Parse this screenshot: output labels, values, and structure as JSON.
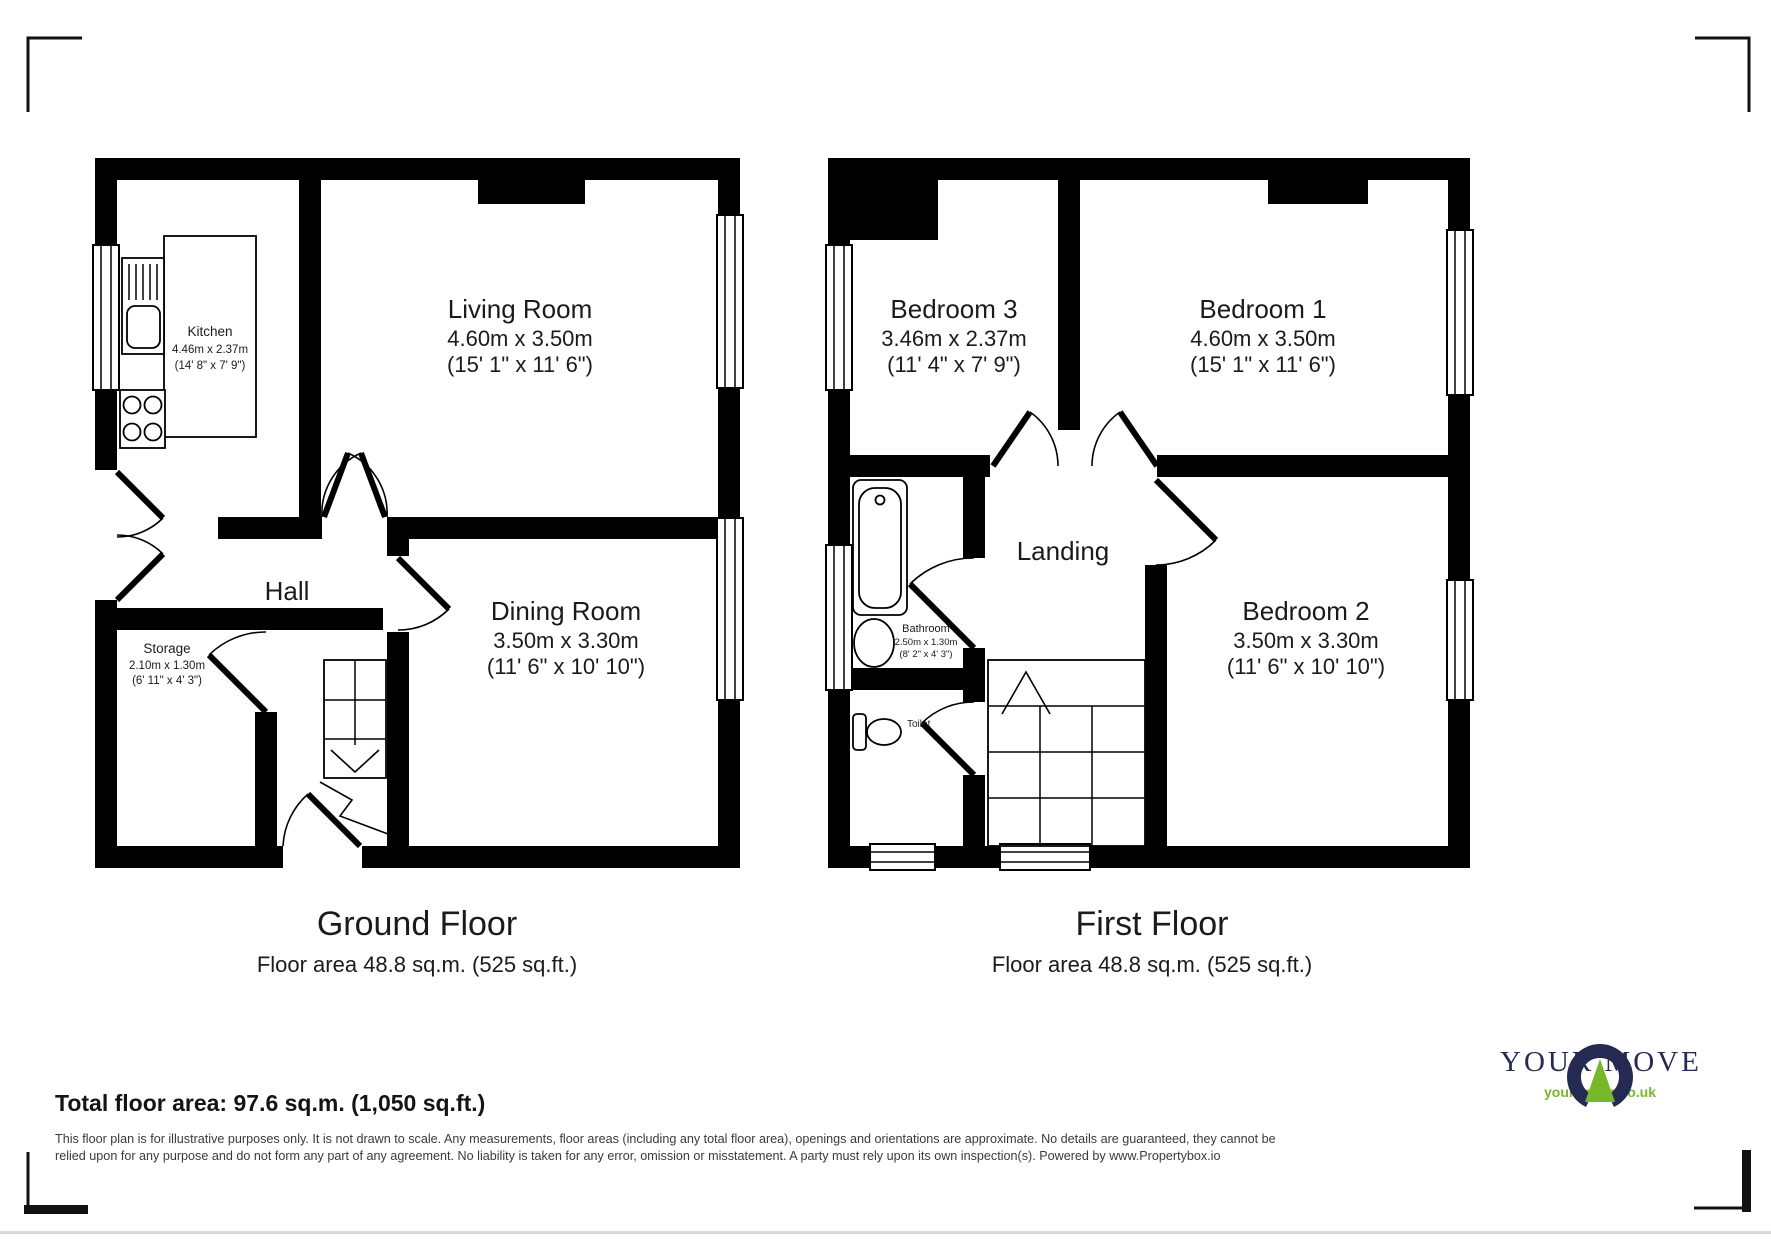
{
  "branding": {
    "logo_name": "YOUR MOVE",
    "logo_url_text": "your-move.co.uk",
    "logo_navy": "#252a52",
    "logo_green": "#76b82a",
    "wall_color": "#000000"
  },
  "summary": {
    "total_area": "Total floor area: 97.6 sq.m. (1,050 sq.ft.)",
    "disclaimer": "This floor plan is for illustrative purposes only. It is not drawn to scale. Any measurements, floor areas (including any total floor area), openings and orientations are approximate. No details are guaranteed, they cannot be relied upon for any purpose and do not form any part of any agreement. No liability is taken for any error, omission or misstatement. A party must rely upon its own inspection(s). Powered by www.Propertybox.io"
  },
  "floors": [
    {
      "name": "Ground Floor",
      "area": "Floor area 48.8 sq.m. (525 sq.ft.)",
      "rooms": [
        {
          "name": "Kitchen",
          "metric": "4.46m x 2.37m",
          "imperial": "(14' 8\" x 7' 9\")"
        },
        {
          "name": "Living Room",
          "metric": "4.60m x 3.50m",
          "imperial": "(15' 1\" x 11' 6\")"
        },
        {
          "name": "Hall"
        },
        {
          "name": "Storage",
          "metric": "2.10m x 1.30m",
          "imperial": "(6' 11\" x 4' 3\")"
        },
        {
          "name": "Dining Room",
          "metric": "3.50m x 3.30m",
          "imperial": "(11' 6\" x 10' 10\")"
        }
      ]
    },
    {
      "name": "First Floor",
      "area": "Floor area 48.8 sq.m. (525 sq.ft.)",
      "rooms": [
        {
          "name": "Bedroom 3",
          "metric": "3.46m x 2.37m",
          "imperial": "(11' 4\" x 7' 9\")"
        },
        {
          "name": "Bedroom 1",
          "metric": "4.60m x 3.50m",
          "imperial": "(15' 1\" x 11' 6\")"
        },
        {
          "name": "Landing"
        },
        {
          "name": "Bathroom",
          "metric": "2.50m x 1.30m",
          "imperial": "(8' 2\" x 4' 3\")"
        },
        {
          "name": "Toilet"
        },
        {
          "name": "Bedroom 2",
          "metric": "3.50m x 3.30m",
          "imperial": "(11' 6\" x 10' 10\")"
        }
      ]
    }
  ]
}
